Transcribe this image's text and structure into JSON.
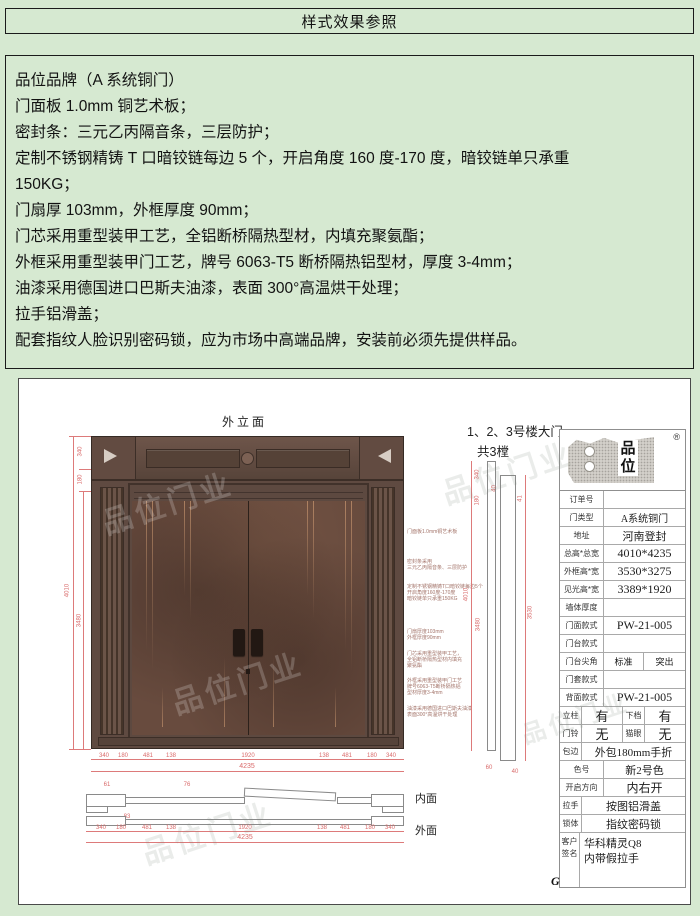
{
  "header": {
    "title": "样式效果参照"
  },
  "spec": {
    "lines": [
      "品位品牌（A 系统铜门）",
      "门面板 1.0mm 铜艺术板；",
      "密封条：三元乙丙隔音条，三层防护；",
      "定制不锈钢精铸 T 口暗铰链每边 5 个，开启角度 160 度-170 度，暗铰链单只承重",
      "150KG；",
      "门扇厚 103mm，外框厚度 90mm；",
      "门芯采用重型装甲工艺，全铝断桥隔热型材，内填充聚氨酯；",
      "外框采用重型装甲门工艺，牌号 6063-T5 断桥隔热铝型材，厚度 3-4mm；",
      "油漆采用德国进口巴斯夫油漆，表面 300°高温烘干处理；",
      "拉手铝滑盖；",
      "配套指纹人脸识别密码锁，应为市场中高端品牌，安装前必须先提供样品。"
    ]
  },
  "drawing": {
    "elevation_title": "外立面",
    "building_note_line1": "1、2、3号楼大门",
    "building_note_line2": "共3樘",
    "watermark": "品位门业",
    "corner_letter": "G",
    "inner_face_label": "内面",
    "outer_face_label": "外面",
    "annotations": [
      "门面板1.0mm铜艺术板",
      "密封条采用\n三元乙丙隔音条、三层防护",
      "定制不锈钢精铸T口暗铰链每边5个\n开启角度160度-170度\n暗铰链单只承重150KG",
      "门扇厚度103mm\n外框厚度90mm",
      "门芯采用重型装甲工艺，\n全铝断桥隔热型材内填充\n聚氨酯",
      "外框采用重型装甲门工艺\n牌号6063-T5断桥隔热铝\n型材厚度3-4mm",
      "油漆采用德国进口巴斯夫油漆\n表面300°高温烘干处理"
    ],
    "dims": {
      "left_seg_top": "340",
      "left_seg_2": "180",
      "left_overall": "4010",
      "left_inner": "3480",
      "bottom_chain": [
        "340",
        "180",
        "481",
        "138",
        "1920",
        "138",
        "481",
        "180",
        "340"
      ],
      "bottom_total": "4235",
      "section_seg_top": "340",
      "section_seg_2": "180",
      "section_small_1": "40",
      "section_small_2": "41",
      "section_left_overall": "4010",
      "section_left_inner": "3480",
      "section_right": "3530",
      "section_bottom_1": "60",
      "section_bottom_2": "40",
      "plan_dim_1": "61",
      "plan_dim_2": "76",
      "plan_dim_3": "83",
      "plan_chain": [
        "340",
        "180",
        "481",
        "138",
        "1920",
        "138",
        "481",
        "180",
        "340"
      ],
      "plan_total": "4235"
    }
  },
  "titleblock": {
    "brand": "品位",
    "registered_mark": "®",
    "order_label": "订单号",
    "order_value": "",
    "doortype_label": "门类型",
    "doortype_value": "A系统铜门",
    "address_label": "地址",
    "address_value": "河南登封",
    "total_label": "总高*总宽",
    "total_value": "4010*4235",
    "frame_label": "外框高*宽",
    "frame_value": "3530*3275",
    "clear_label": "见光高*宽",
    "clear_value": "3389*1920",
    "wall_label": "墙体厚度",
    "wall_value": "",
    "face_label": "门面款式",
    "face_value": "PW-21-005",
    "platform_label": "门台款式",
    "platform_value": "",
    "corner_label": "门台尖角",
    "corner_std": "标准",
    "corner_out": "突出",
    "cover_label": "门套款式",
    "cover_value": "",
    "back_label": "背面款式",
    "back_value": "PW-21-005",
    "pillar_label": "立柱",
    "pillar_value": "有",
    "sill_label": "下档",
    "sill_value": "有",
    "bell_label": "门铃",
    "bell_value": "无",
    "peephole_label": "猫眼",
    "peephole_value": "无",
    "edge_label": "包边",
    "edge_value": "外包180mm手折",
    "color_label": "色号",
    "color_value": "新2号色",
    "open_label": "开启方向",
    "open_value": "内右开",
    "handle_label": "拉手",
    "handle_value": "按图铝滑盖",
    "lock_label": "锁体",
    "lock_value": "指纹密码锁",
    "sign_label": "客户签名",
    "sign_value": "华科精灵Q8\n内带假拉手"
  }
}
